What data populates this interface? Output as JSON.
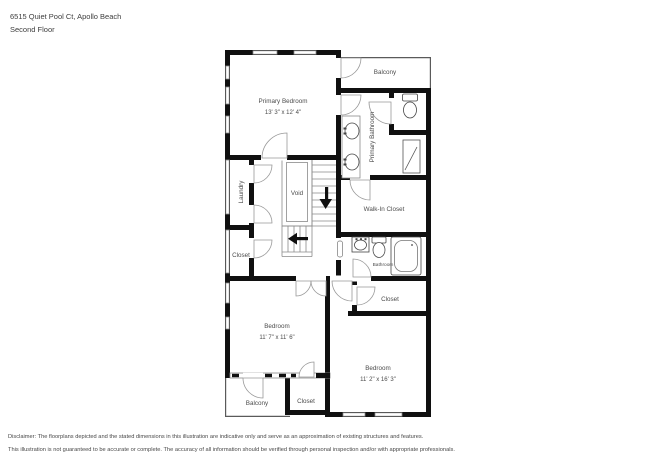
{
  "header": {
    "address": "6515 Quiet Pool Ct, Apollo Beach",
    "floor": "Second Floor"
  },
  "rooms": {
    "primary_bedroom": {
      "name": "Primary Bedroom",
      "dims": "13' 3\" x 12' 4\""
    },
    "balcony_top": {
      "name": "Balcony"
    },
    "primary_bathroom": {
      "name": "Primary Bathroom"
    },
    "laundry": {
      "name": "Laundry"
    },
    "void": {
      "name": "Void"
    },
    "walk_in_closet": {
      "name": "Walk-In Closet"
    },
    "closet_left": {
      "name": "Closet"
    },
    "bathroom": {
      "name": "Bathroom"
    },
    "closet_right": {
      "name": "Closet"
    },
    "bedroom_left": {
      "name": "Bedroom",
      "dims": "11' 7\" x 11' 6\""
    },
    "bedroom_right": {
      "name": "Bedroom",
      "dims": "11' 2\" x 16' 3\""
    },
    "balcony_bottom": {
      "name": "Balcony"
    },
    "closet_bottom": {
      "name": "Closet"
    }
  },
  "disclaimer": {
    "line1": "Disclaimer: The floorplans depicted and the stated dimensions in this illustration are indicative only and serve as an approximation of existing structures and features.",
    "line2": "This illustration is not guaranteed to be accurate or complete. The accuracy of all information should be verified through personal inspection and/or with appropriate professionals."
  },
  "colors": {
    "wall": "#101010",
    "thin_line": "#8a8a8a",
    "label_text": "#4c4c4c"
  }
}
